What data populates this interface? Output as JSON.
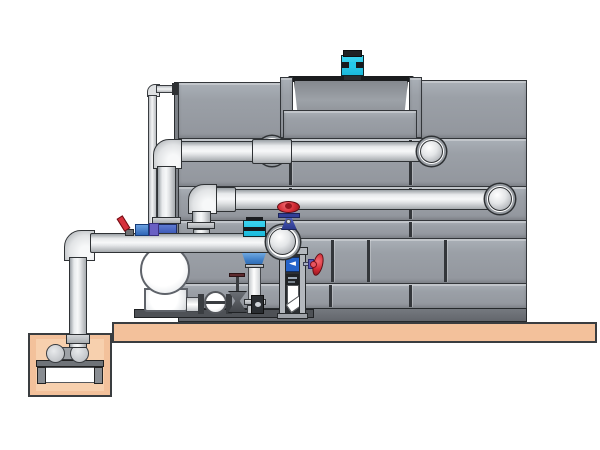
{
  "scene": {
    "description": "3D technical illustration of a cooling tower with fan motor, external supply and return piping, pump skid with vertical multistage pump and valves, and a sump pit with submersible pump on a concrete slab"
  },
  "palette": {
    "background": "#ffffff",
    "tank_panel_gray": "#9aa0a8",
    "seam_dark": "#33363a",
    "pipe_light": "#f0f1f3",
    "slab_tan": "#f3c19b",
    "pit_inner_tan": "#f7d0ae",
    "fan_motor_cyan": "#25c8ea",
    "pump_head_blue": "#3c7cc4",
    "valve_body_navy": "#414fae",
    "handwheel_red": "#d42b35",
    "indicator_box_blue": "#2563c9",
    "skid_rail_dark": "#4e5156"
  },
  "frame": {
    "arrow_glyph": "◄"
  },
  "components": [
    "cooling-tower-shell",
    "fan-cowl",
    "fan-motor",
    "upper-wall-pipe",
    "lower-wall-pipe",
    "main-suction-pipe",
    "riser-pipe",
    "sump-pit",
    "sump-pump",
    "concrete-slab",
    "centrifugal-pump",
    "check-valve",
    "gate-valve",
    "vertical-multistage-pump",
    "red-handwheel-valve-top",
    "red-handwheel-valve-side",
    "instrument-frame",
    "flow-indicator",
    "makeup-line",
    "feed-valve-cluster"
  ]
}
